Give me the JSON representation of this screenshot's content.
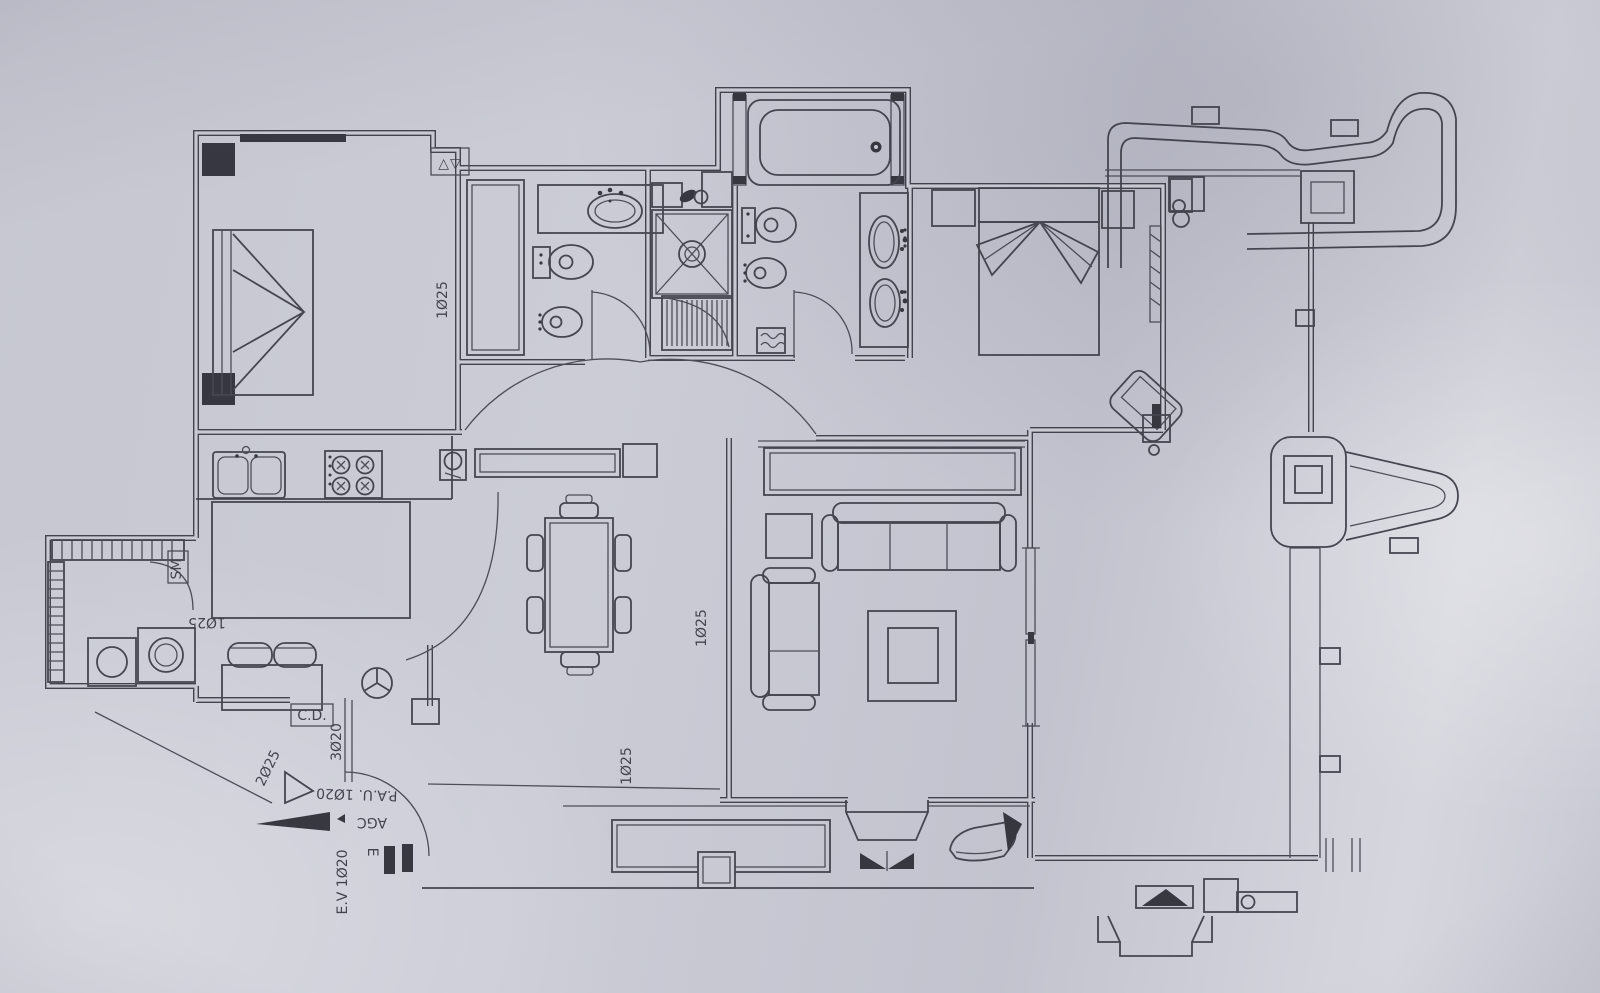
{
  "palette": {
    "paper": "#c9cad4",
    "ink": "#383944"
  },
  "labels": {
    "pipe_a": "1Ø25",
    "pipe_b": "1Ø25",
    "pipe_c": "1Ø25",
    "pipe_d": "1Ø25",
    "pipe_e": "2Ø25",
    "pipe_f": "3Ø20",
    "cd": "C.D.",
    "pau": "P.A.U. 1Ø20",
    "agc": "AGC",
    "e": "E",
    "ev": "E.V 1Ø20",
    "sm": "SM",
    "vent": "△▽"
  }
}
